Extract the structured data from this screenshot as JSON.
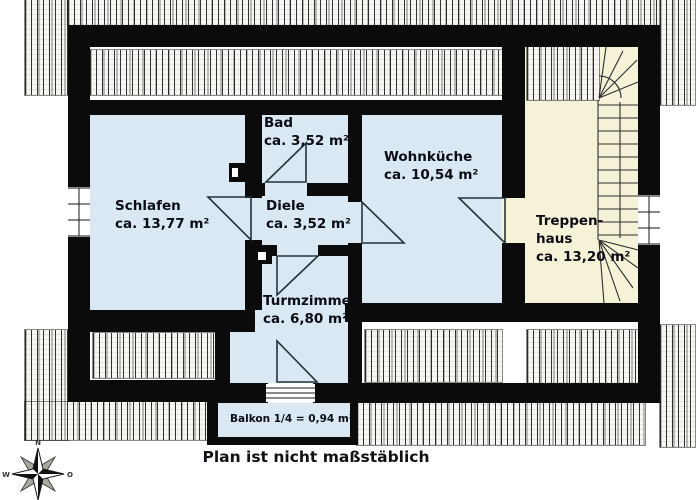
{
  "plan": {
    "rooms": {
      "schlafen": {
        "name": "Schlafen",
        "area": "ca. 13,77 m²"
      },
      "bad": {
        "name": "Bad",
        "area": "ca. 3,52 m²"
      },
      "diele": {
        "name": "Diele",
        "area": "ca. 3,52 m²"
      },
      "wohnkueche": {
        "name": "Wohnküche",
        "area": "ca. 10,54 m²"
      },
      "turmzimmer": {
        "name": "Turmzimmer",
        "area": "ca. 6,80 m²"
      },
      "treppenhaus": {
        "name_line1": "Treppen-",
        "name_line2": "haus",
        "area": "ca. 13,20 m²"
      },
      "balkon": {
        "label": "Balkon 1/4 = 0,94 m²"
      }
    },
    "footnote": "Plan ist nicht maßstäblich",
    "compass": {
      "north": "N",
      "west": "W",
      "east": "O"
    },
    "colors": {
      "wall": "#0b0b0b",
      "room_fill": "#d9e8f3",
      "stair_fill": "#f6f2d8",
      "line": "#22333d"
    }
  }
}
